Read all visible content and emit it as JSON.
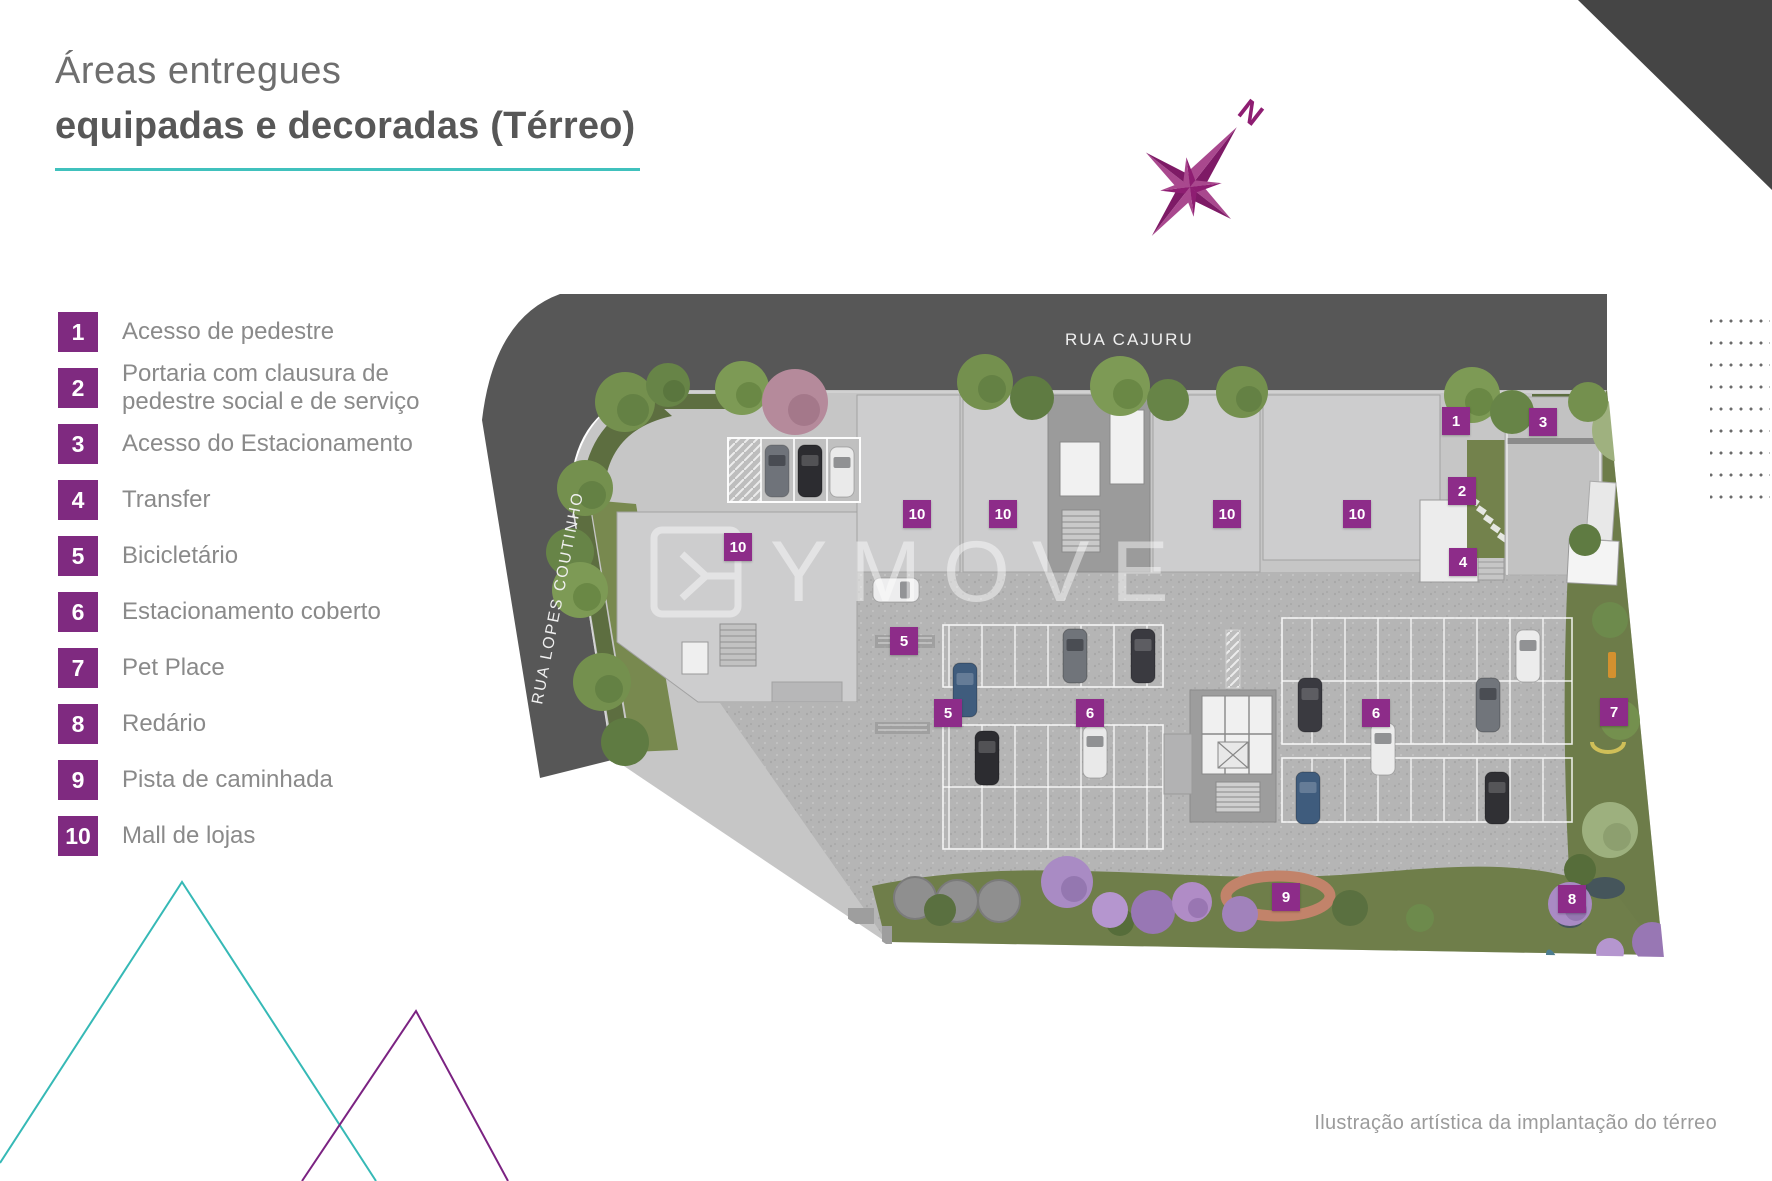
{
  "title": {
    "line1": "Áreas entregues",
    "line2": "equipadas e decoradas (Térreo)"
  },
  "legend": {
    "items": [
      {
        "num": "1",
        "label": "Acesso de pedestre"
      },
      {
        "num": "2",
        "label": "Portaria com clausura de pedestre social e de serviço"
      },
      {
        "num": "3",
        "label": "Acesso do Estacionamento"
      },
      {
        "num": "4",
        "label": "Transfer"
      },
      {
        "num": "5",
        "label": "Bicicletário"
      },
      {
        "num": "6",
        "label": "Estacionamento coberto"
      },
      {
        "num": "7",
        "label": "Pet Place"
      },
      {
        "num": "8",
        "label": "Redário"
      },
      {
        "num": "9",
        "label": "Pista de caminhada"
      },
      {
        "num": "10",
        "label": "Mall de lojas"
      }
    ]
  },
  "map": {
    "streets": {
      "top": "RUA CAJURU",
      "left": "RUA  LOPES COUTINHO"
    },
    "compass_label": "N",
    "watermark": "YMOVE",
    "markers": [
      {
        "num": "1",
        "x": 1036,
        "y": 131
      },
      {
        "num": "2",
        "x": 1042,
        "y": 201
      },
      {
        "num": "3",
        "x": 1123,
        "y": 132
      },
      {
        "num": "4",
        "x": 1043,
        "y": 272
      },
      {
        "num": "5",
        "x": 484,
        "y": 351
      },
      {
        "num": "5",
        "x": 528,
        "y": 423
      },
      {
        "num": "6",
        "x": 670,
        "y": 423
      },
      {
        "num": "6",
        "x": 956,
        "y": 423
      },
      {
        "num": "7",
        "x": 1194,
        "y": 422
      },
      {
        "num": "8",
        "x": 1152,
        "y": 609
      },
      {
        "num": "9",
        "x": 866,
        "y": 607
      },
      {
        "num": "10",
        "x": 497,
        "y": 224
      },
      {
        "num": "10",
        "x": 583,
        "y": 224
      },
      {
        "num": "10",
        "x": 807,
        "y": 224
      },
      {
        "num": "10",
        "x": 937,
        "y": 224
      },
      {
        "num": "10",
        "x": 318,
        "y": 257
      }
    ]
  },
  "caption": "Ilustração artística da implantação do térreo",
  "colors": {
    "accent_teal": "#40c1bd",
    "legend_purple": "#7f2a80",
    "marker_purple": "#8d2c89",
    "compass_purple": "#8e1d72",
    "chevron_teal": "#36b9b6",
    "chevron_purple": "#7b2382",
    "road_gray": "#575757",
    "title_gray": "#6e6e6e"
  }
}
